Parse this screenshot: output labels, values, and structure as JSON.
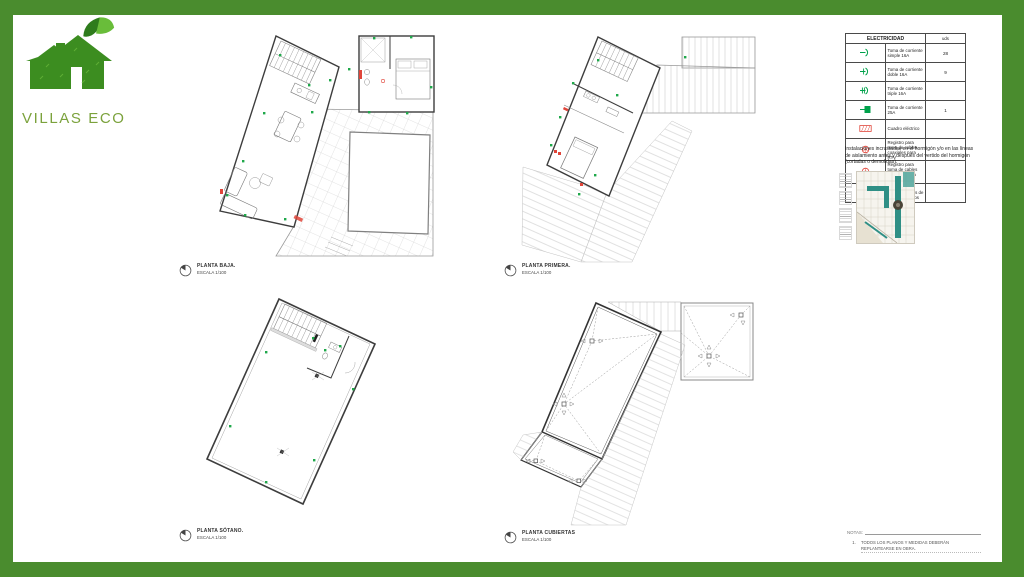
{
  "logo": {
    "text": "VILLAS ECO"
  },
  "plans": [
    {
      "id": "planta-baja",
      "title": "PLANTA BAJA.",
      "scale": "ESCALA 1/100"
    },
    {
      "id": "planta-primera",
      "title": "PLANTA PRIMERA.",
      "scale": "ESCALA 1/100"
    },
    {
      "id": "planta-sotano",
      "title": "PLANTA SÓTANO.",
      "scale": "ESCALA 1/100"
    },
    {
      "id": "planta-cubiertas",
      "title": "PLANTA CUBIERTAS",
      "scale": "ESCALA 1/100"
    }
  ],
  "legend": {
    "title": "ELECTRICIDAD",
    "units_header": "uds",
    "rows": [
      {
        "symbol": "socket-single",
        "label": "Toma de corriente simple 16A",
        "uds": "28"
      },
      {
        "symbol": "socket-double",
        "label": "Toma de corriente doble 16A",
        "uds": "9"
      },
      {
        "symbol": "socket-triple",
        "label": "Toma de corriente triple 16A",
        "uds": ""
      },
      {
        "symbol": "socket-25a",
        "label": "Toma de corriente 25A",
        "uds": "1"
      },
      {
        "symbol": "electrical-panel",
        "label": "Cuadro eléctrico",
        "uds": ""
      },
      {
        "symbol": "register-rtv",
        "label": "Registro para toma de cables coaxiales para RTV",
        "uds": ""
      },
      {
        "symbol": "register-tba",
        "label": "Registro para toma de cables coaxiales para TBA",
        "uds": ""
      },
      {
        "symbol": "register-pares",
        "label": "Registro para toma de cables de pares trenzados",
        "uds": ""
      }
    ]
  },
  "installation_note": "Instalaciones incrustadas en el hormigón y/o en las líneas de aislamiento antes y después del vertido del hormigón (cortadas o demolidas).",
  "notes_box": {
    "header": "NOTAS:",
    "item_number": "1.",
    "item_text": "TODOS LOS PLANOS Y MEDIDAS DEBERÁN REPLANTEARSE EN OBRA."
  },
  "colors": {
    "frame_green": "#4a8c2e",
    "logo_green": "#7ba23c",
    "symbol_green": "#00a14b",
    "symbol_red": "#e0453a"
  }
}
